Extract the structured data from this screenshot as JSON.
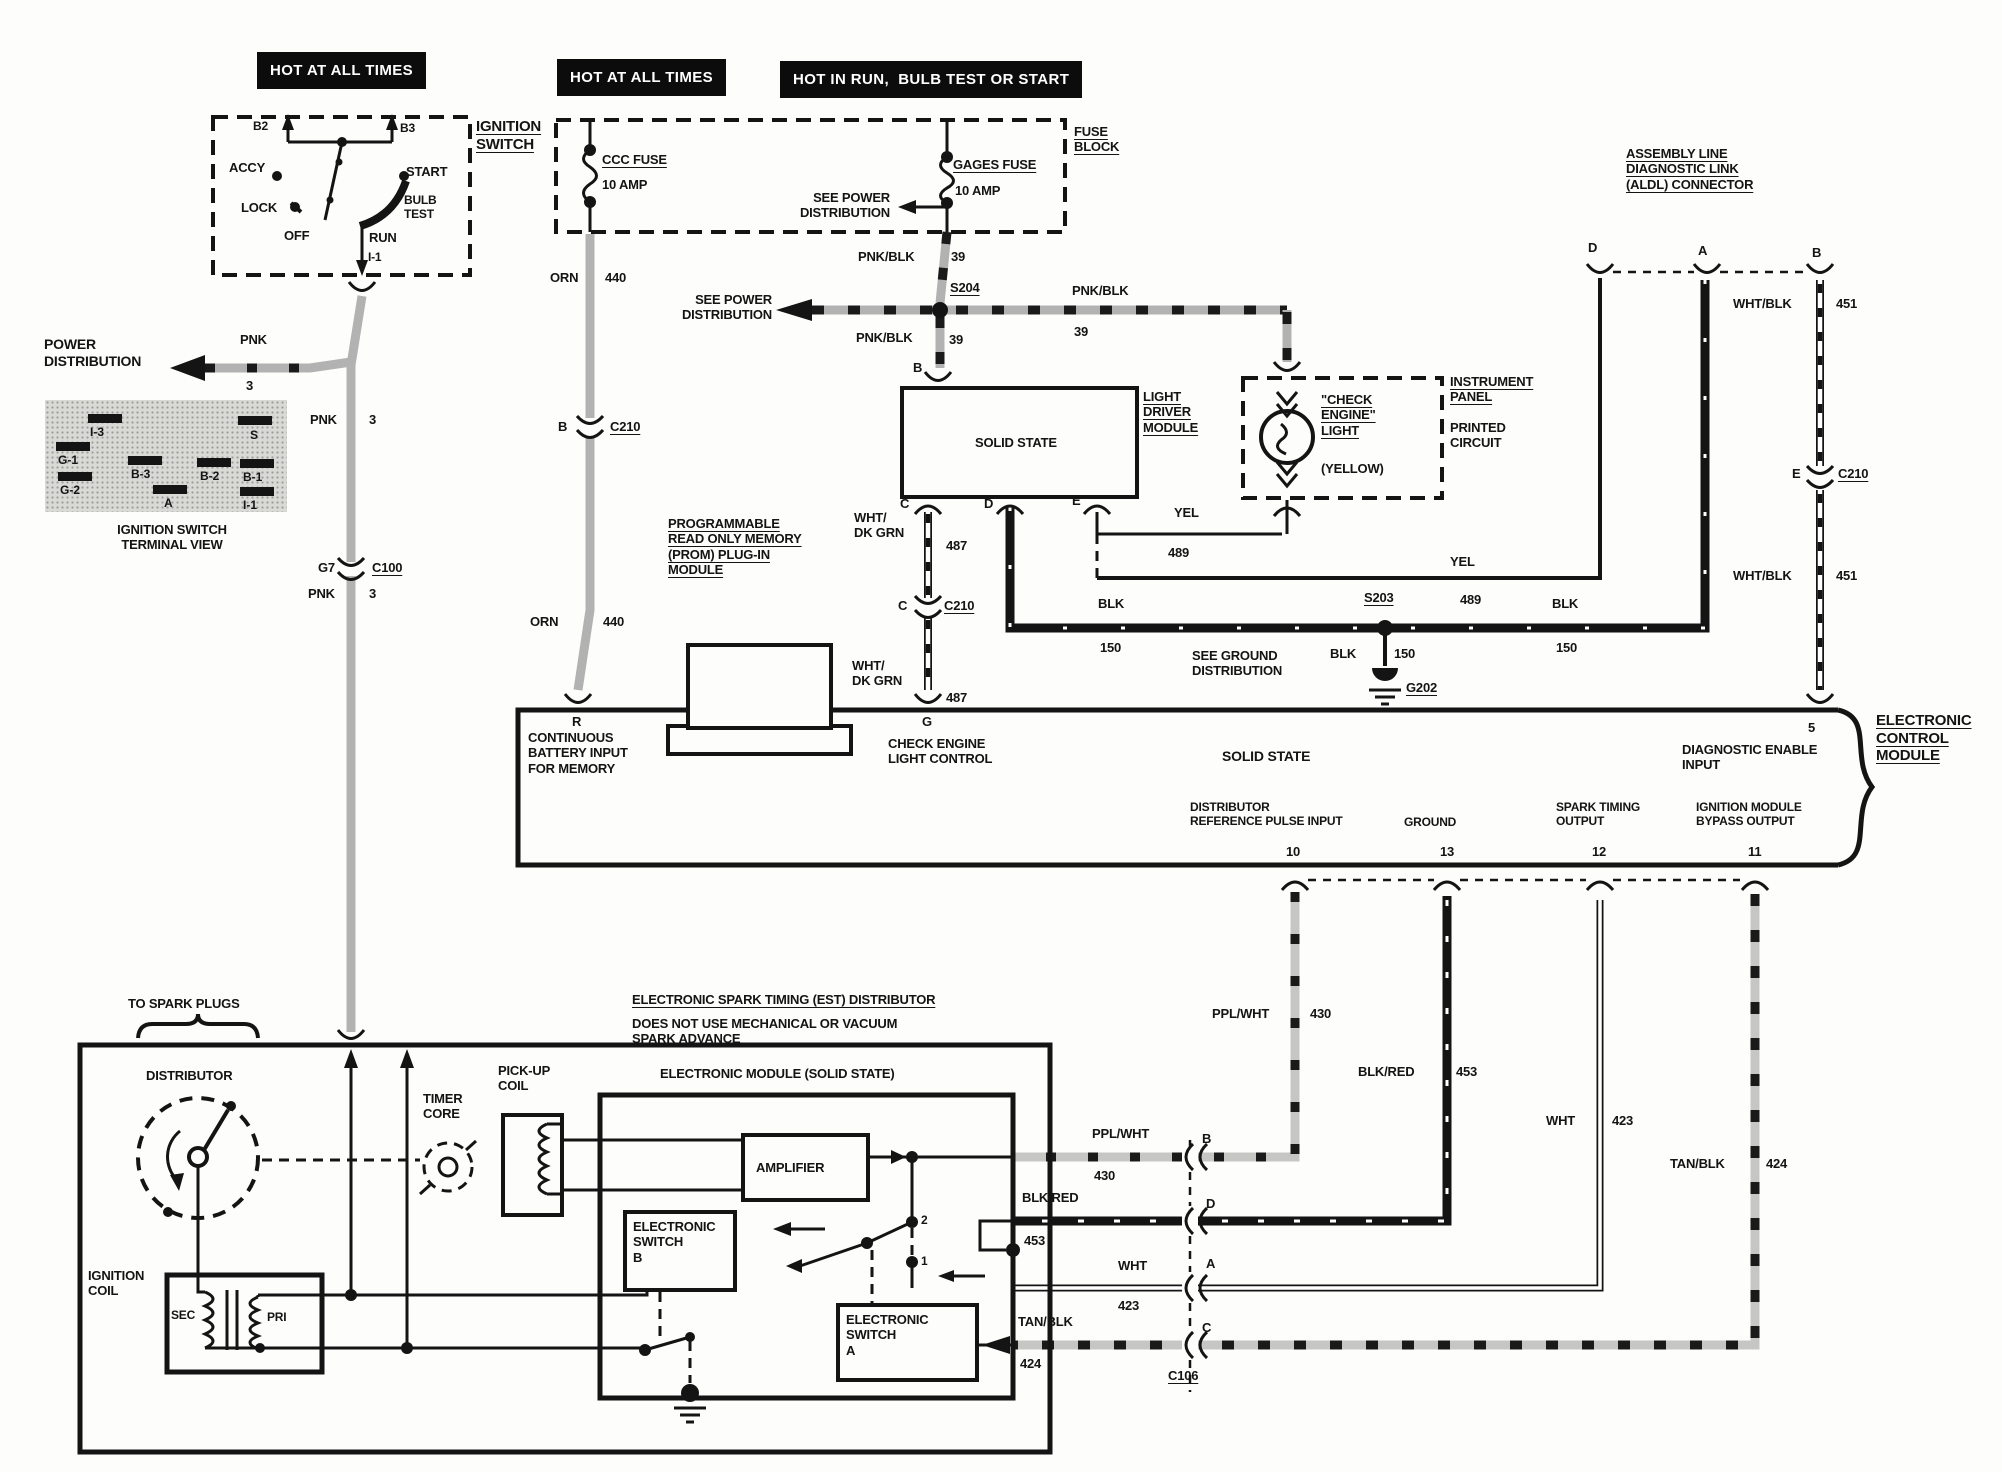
{
  "banners": {
    "b1": "HOT AT ALL TIMES",
    "b2": "HOT AT ALL TIMES",
    "b3": "HOT IN RUN,  BULB TEST OR START"
  },
  "ignition_switch": {
    "title": "IGNITION\nSWITCH",
    "b2": "B2",
    "b3": "B3",
    "accy": "ACCY",
    "lock": "LOCK",
    "off": "OFF",
    "run": "RUN",
    "start": "START",
    "bulb_test": "BULB\nTEST",
    "i1": "I-1"
  },
  "power_dist": "POWER\nDISTRIBUTION",
  "see_power": "SEE POWER\nDISTRIBUTION",
  "see_ground": "SEE GROUND\nDISTRIBUTION",
  "terminal_view": {
    "caption": "IGNITION SWITCH\nTERMINAL VIEW",
    "terms": [
      "I-3",
      "S",
      "G-1",
      "B-3",
      "B-2",
      "B-1",
      "G-2",
      "A",
      "I-1"
    ]
  },
  "fuse_block": {
    "title": "FUSE\nBLOCK",
    "ccc": "CCC FUSE",
    "ccc_amp": "10 AMP",
    "gages": "GAGES FUSE",
    "gages_amp": "10 AMP"
  },
  "light_module": {
    "title": "LIGHT\nDRIVER\nMODULE",
    "solid_state": "SOLID STATE"
  },
  "cel": {
    "name": "\"CHECK\nENGINE\"\nLIGHT",
    "color": "(YELLOW)"
  },
  "panel": {
    "t": "INSTRUMENT\nPANEL",
    "b": "PRINTED\nCIRCUIT"
  },
  "aldl": {
    "title": "ASSEMBLY LINE\nDIAGNOSTIC LINK\n(ALDL) CONNECTOR"
  },
  "prom": {
    "title": "PROGRAMMABLE\nREAD ONLY MEMORY\n(PROM) PLUG-IN\nMODULE"
  },
  "ecm": {
    "title": "ELECTRONIC\nCONTROL\nMODULE",
    "solid_state": "SOLID STATE",
    "batt": "CONTINUOUS\nBATTERY INPUT\nFOR MEMORY",
    "cel_ctl": "CHECK ENGINE\nLIGHT CONTROL",
    "diag": "DIAGNOSTIC ENABLE\nINPUT",
    "ref": "DISTRIBUTOR\nREFERENCE PULSE INPUT",
    "gnd": "GROUND",
    "spark": "SPARK TIMING\nOUTPUT",
    "bypass": "IGNITION MODULE\nBYPASS OUTPUT",
    "t5": "5",
    "t10": "10",
    "t13": "13",
    "t12": "12",
    "t11": "11"
  },
  "est_note": {
    "l1": "ELECTRONIC SPARK TIMING (EST) DISTRIBUTOR",
    "l2": "DOES NOT USE MECHANICAL OR VACUUM\nSPARK ADVANCE"
  },
  "distributor": {
    "label": "DISTRIBUTOR",
    "timer": "TIMER\nCORE",
    "pickup": "PICK-UP\nCOIL",
    "module": "ELECTRONIC MODULE (SOLID STATE)",
    "amplifier": "AMPLIFIER",
    "sw_b": "ELECTRONIC\nSWITCH\nB",
    "sw_a": "ELECTRONIC\nSWITCH\nA",
    "coil": "IGNITION\nCOIL",
    "sec": "SEC",
    "pri": "PRI",
    "spark_plugs": "TO SPARK PLUGS",
    "c1": "1",
    "c2": "2"
  },
  "wires": {
    "pnk": {
      "c": "PNK",
      "n": "3"
    },
    "orn": {
      "c": "ORN",
      "n": "440"
    },
    "pnkblk": {
      "c": "PNK/BLK",
      "n": "39"
    },
    "whtdkgrn": {
      "c": "WHT/\nDK GRN",
      "n": "487"
    },
    "whtblk": {
      "c": "WHT/BLK",
      "n": "451"
    },
    "yel": {
      "c": "YEL",
      "n": "489"
    },
    "blk": {
      "c": "BLK",
      "n": "150"
    },
    "pplwht": {
      "c": "PPL/WHT",
      "n": "430"
    },
    "blkred": {
      "c": "BLK/RED",
      "n": "453"
    },
    "wht": {
      "c": "WHT",
      "n": "423"
    },
    "tanblk": {
      "c": "TAN/BLK",
      "n": "424"
    }
  },
  "connectors": {
    "c100": "C100",
    "c210": "C210",
    "c106": "C106",
    "s204": "S204",
    "s203": "S203",
    "g202": "G202",
    "g7": "G7"
  },
  "terms": {
    "a": "A",
    "b": "B",
    "c": "C",
    "d": "D",
    "e": "E",
    "g": "G",
    "r": "R"
  }
}
